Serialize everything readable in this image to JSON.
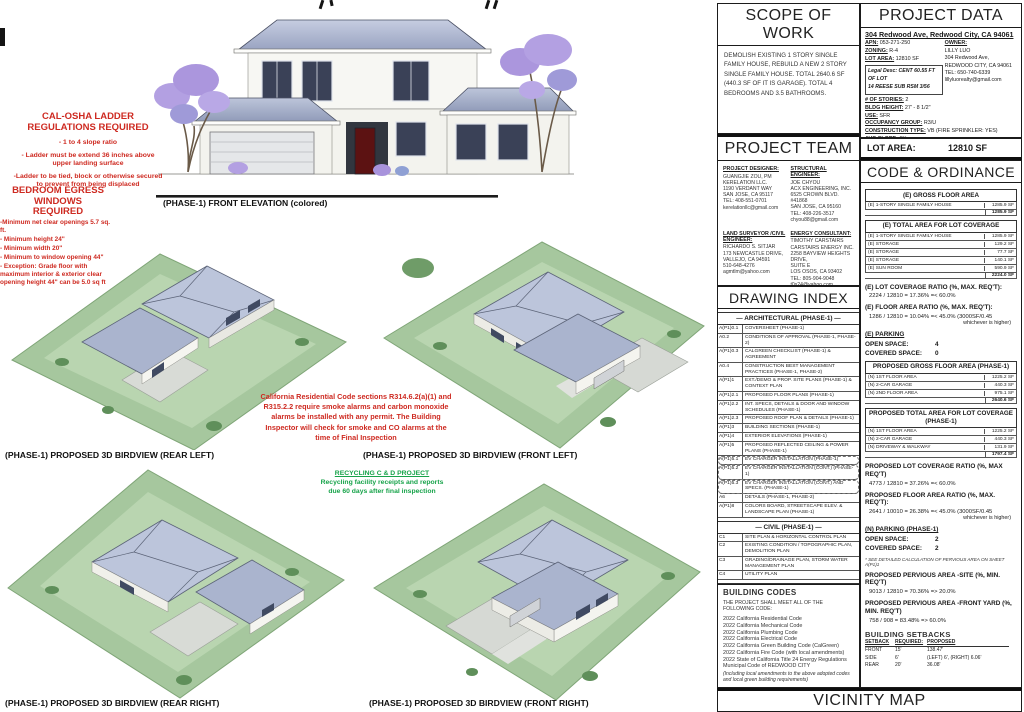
{
  "annotations": {
    "cal_osha": {
      "title_line1": "CAL-OSHA LADDER",
      "title_line2": "REGULATIONS REQUIRED",
      "items": [
        "- 1 to 4 slope ratio",
        "- Ladder must be extend 36 inches above upper landing surface",
        "-Ladder to be tied, block or otherwise secured to prevent from being displaced"
      ]
    },
    "egress": {
      "title_line1": "BEDROOM EGRESS",
      "title_line2": "WINDOWS",
      "title_line3": "REQUIRED",
      "items": [
        "-Minimum net clear openings 5.7 sq. ft.",
        "- Minimum height 24\"",
        "- Minimum width 20\"",
        "- Minimum to window opening 44\"",
        "- Exception: Grade floor with maximum interior & exterior clear opening height 44\" can be 5.0 sq ft"
      ]
    },
    "smoke_co": "California Residential Code sections R314.6.2(a)(1) and R315.2.2 require smoke alarms and carbon monoxide alarms be installed with any permit. The Building Inspector will check for smoke and CO alarms at the time of Final Inspection",
    "recycling": {
      "title": "RECYCLING C & D PROJECT",
      "body": "Recycling facility receipts and reports due 60 days after final inspection"
    }
  },
  "captions": {
    "front_elevation": "(PHASE-1) FRONT ELEVATION (colored)",
    "rear_left": "(PHASE-1) PROPOSED 3D BIRDVIEW (REAR LEFT)",
    "front_left": "(PHASE-1) PROPOSED 3D BIRDVIEW (FRONT LEFT)",
    "rear_right": "(PHASE-1) PROPOSED 3D BIRDVIEW (REAR RIGHT)",
    "front_right": "(PHASE-1) PROPOSED 3D BIRDVIEW (FRONT RIGHT)"
  },
  "scope_of_work": {
    "title": "SCOPE OF WORK",
    "body": "DEMOLISH EXISTING 1 STORY SINGLE FAMILY HOUSE, REBUILD A NEW 2 STORY SINGLE FAMILY HOUSE. TOTAL 2640.6 SF (440.3 SF OF IT IS GARAGE). TOTAL 4 BEDROOMS AND 3.5 BATHROOMS."
  },
  "project_data": {
    "title": "PROJECT DATA",
    "address": "304 Redwood Ave, Redwood City, CA 94061",
    "left_fields": [
      {
        "label": "APN:",
        "value": "053-271-250"
      },
      {
        "label": "ZONING:",
        "value": "R-4"
      },
      {
        "label": "LOT AREA:",
        "value": "12810 SF"
      }
    ],
    "legal_line1": "Legal Desc: CENT 60.55 FT OF LOT",
    "legal_line2": "14 REESE SUB RSM 3/56",
    "owner_heading": "OWNER:",
    "owner_lines": [
      "LILLY LUO",
      "304 Redwood Ave,",
      "REDWOOD CITY, CA 94061",
      "TEL:    650-740-6339",
      "lillyluorealty@gmail.com"
    ],
    "bottom_fields": [
      {
        "label": "# OF STORIES:",
        "value": "2"
      },
      {
        "label": "BLDG HEIGHT:",
        "value": "27' - 8 1/2\""
      },
      {
        "label": "USE:",
        "value": "SFR"
      },
      {
        "label": "OCCUPANCY GROUP:",
        "value": "R3/U"
      },
      {
        "label": "CONSTRUCTION TYPE:",
        "value": "VB (FIRE SPRINKLER: YES)"
      },
      {
        "label": "AVG SLOPE:",
        "value": "6%"
      }
    ],
    "lot_area_label": "LOT AREA:",
    "lot_area_value": "12810 SF"
  },
  "project_team": {
    "title": "PROJECT TEAM",
    "designer": {
      "heading": "PROJECT DESIGNER:",
      "lines": [
        "GUANGJIE ZOU, PM",
        "KERELATION LLC.",
        "1190 VERDANT WAY",
        "SAN JOSE, CA 95117",
        "TEL: 408-551-0701",
        "kerelationllc@gmail.com"
      ]
    },
    "structural": {
      "heading": "STRUCTURAL ENGINEER:",
      "lines": [
        "JOE CHYOU",
        "ACX ENGINEERING, INC.",
        "6525 CROWN BLVD. #41868",
        "SAN JOSE, CA 95160",
        "TEL: 408-226-3517",
        "chyou88@gmail.com"
      ]
    },
    "surveyor": {
      "heading": "LAND SURVEYOR /CIVIL ENGINEER:",
      "lines": [
        "RICHARDO S. SITJAR",
        "173 NEWCASTLE DRIVE,",
        "VALLEJO, CA 94591",
        "510-648-4276",
        "agmtlm@yahoo.com"
      ]
    },
    "energy": {
      "heading": "ENERGY CONSULTANT:",
      "lines": [
        "TIMOTHY CARSTAIRS",
        "CARSTAIRS ENERGY INC.",
        "2258 BAYVIEW HEIGHTS DRIVE,",
        "SUITE E",
        "LOS OSOS, CA 93402",
        "TEL: 805-904-9048",
        "t0s24@yahoo.com"
      ]
    }
  },
  "drawing_index": {
    "title": "DRAWING INDEX",
    "arch_heading": "— ARCHITECTURAL (PHASE-1) —",
    "arch_rows": [
      {
        "code": "A(P1)0.1",
        "title": "COVERSHEET (PHASE-1)"
      },
      {
        "code": "A0.2",
        "title": "CONDITIONS OF APPROVAL (PHASE-1, PHASE-2)"
      },
      {
        "code": "A(P1)0.3",
        "title": "CALGREEN CHECKLIST (PHASE-1) & AGREEMENT"
      },
      {
        "code": "A0.4",
        "title": "CONSTRUCTION BEST MANAGEMENT PRACTICES (PHASE-1, PHASE-2)"
      },
      {
        "code": "A(P1)1",
        "title": "EXT./DEMO & PROP. SITE PLANS (PHASE-1) & CONTEXT PLAN"
      },
      {
        "code": "A(P1)2.1",
        "title": "PROPOSED FLOOR PLANS (PHASE-1)"
      },
      {
        "code": "A(P1)2.2",
        "title": "INT. SPECS, DETAILS & DOOR AND WINDOW SCHEDULES (PHASE-1)"
      },
      {
        "code": "A(P1)2.3",
        "title": "PROPOSED ROOF PLAN & DETAILS (PHASE-1)"
      },
      {
        "code": "A(P1)3",
        "title": "BUILDING SECTIONS (PHASE-1)"
      },
      {
        "code": "A(P1)4",
        "title": "EXTERIOR ELEVATIONS (PHASE-1)"
      },
      {
        "code": "A(P1)5",
        "title": "PROPOSED REFLECTED CEILING & POWER PLANS (PHASE-1)"
      },
      {
        "code": "A(P1)5.1",
        "title": "EV CHARGER INSTALLATION (PHASE-1)"
      },
      {
        "code": "A(P1)5.2",
        "title": "EV CHARGER INSTALLATION (CONT.) (PHASE-1)"
      },
      {
        "code": "A(P1)5.3",
        "title": "EV CHARGER INSTALLATION (CONT.) AND SPECS. (PHASE-1)"
      },
      {
        "code": "A6",
        "title": "DETAILS (PHASE-1, PHASE-2)"
      },
      {
        "code": "A(P1)8",
        "title": "COLORS BOARD, STREETSCAPE ELEV. & LANDSCAPE PLAN (PHASE-1)"
      }
    ],
    "civil_heading": "— CIVIL (PHASE-1) —",
    "civil_rows": [
      {
        "code": "C1",
        "title": "SITE PLAN & HORIZONTAL CONTROL PLAN"
      },
      {
        "code": "C2",
        "title": "EXISTING CONDITION / TOPOGRAPHIC PLAN, DEMOLITION PLAN"
      },
      {
        "code": "C3",
        "title": "GRADING/DRAINAGE PLAN, STORM WATER MANAGEMENT PLAN"
      },
      {
        "code": "C4",
        "title": "UTILITY PLAN"
      }
    ],
    "energy_heading": "— ENERGY REPORT —",
    "energy_rows": [
      {
        "code": "T24.1",
        "title": "ENERGY REPORT - CF1R-PRF-01"
      },
      {
        "code": "T24.2",
        "title": "ENERGY REPORT - CF1R-PRF-01 & RMS"
      }
    ],
    "structural_heading": "— STRUCTURAL —",
    "structural_rows": [
      {
        "code": "S-1",
        "title": "STRUCTURE NOTES"
      },
      {
        "code": "S-2",
        "title": "STRUCTURAL DETAILS"
      },
      {
        "code": "S-3",
        "title": "STRUCTURAL DETAILS"
      },
      {
        "code": "S-4",
        "title": "FOUNDATION PLAN"
      },
      {
        "code": "S-5",
        "title": "2ND FLOOR FRAMING & FOUNDATION PLANS"
      },
      {
        "code": "S-6",
        "title": "UPPER ROOF AND LOW ROOF FRAMING PLANS"
      }
    ]
  },
  "building_codes": {
    "title": "BUILDING CODES",
    "intro": "THE PROJECT SHALL MEET ALL OF THE FOLLOWING CODE:",
    "items": [
      "2022   California Residential Code",
      "2022   California Mechanical Code",
      "2022   California Plumbing Code",
      "2022   California Electrical Code",
      "2022   California Green Building Code (CalGreen)",
      "2022   California Fire Code (with local amendments)",
      "2022   State of California Title 24 Energy Regulations",
      "Municipal Code of REDWOOD CITY"
    ],
    "note": "(Including local amendments to the above adopted codes and local green building requirements)"
  },
  "code_ordinance": {
    "title": "CODE & ORDINANCE",
    "e_gross_heading": "(E) GROSS FLOOR AREA",
    "e_gross_rows": [
      {
        "label": "(E) 1-STORY SINGLE FAMILY HOUSE",
        "value": "1285.9 SF"
      }
    ],
    "e_gross_total": "1285.9 SF",
    "e_cov_heading": "(E) TOTAL AREA FOR LOT COVERAGE",
    "e_cov_rows": [
      {
        "label": "(E) 1-STORY SINGLE FAMILY HOUSE",
        "value": "1285.9 SF"
      },
      {
        "label": "(E) STORAGE",
        "value": "129.2 SF"
      },
      {
        "label": "(E) STORAGE",
        "value": "77.7 SF"
      },
      {
        "label": "(E) STORAGE",
        "value": "140.1 SF"
      },
      {
        "label": "(E) SUN ROOM",
        "value": "590.9 SF"
      }
    ],
    "e_cov_total": "2224.0 SF",
    "e_lot_ratio_title": "(E) LOT COVERAGE RATIO (%, MAX. REQ'T):",
    "e_lot_ratio_calc": "2224 / 12810     =  17.36%  =< 60.0%",
    "e_far_title": "(E) FLOOR AREA RATIO (%, MAX. REQ'T):",
    "e_far_calc": "1286 / 12810     =  10.04%  =< 45.0%   (3000SF/0.45",
    "e_far_note": "whichever is higher)",
    "e_parking_title": "(E) PARKING",
    "open_space_label": "OPEN SPACE:",
    "covered_space_label": "COVERED SPACE:",
    "e_open": "4",
    "e_covered": "0",
    "p_gross_heading": "PROPOSED GROSS FLOOR AREA (PHASE-1)",
    "p_gross_rows": [
      {
        "label": "(N) 1ST FLOOR AREA",
        "value": "1225.2 SF"
      },
      {
        "label": "(N) 2-CAR GARAGE",
        "value": "440.3 SF"
      },
      {
        "label": "(N) 2ND FLOOR AREA",
        "value": "975.1 SF"
      }
    ],
    "p_gross_total": "2640.6 SF",
    "p_cov_heading": "PROPOSED TOTAL AREA FOR LOT COVERAGE (PHASE-1)",
    "p_cov_rows": [
      {
        "label": "(N) 1ST FLOOR AREA",
        "value": "1225.2 SF"
      },
      {
        "label": "(N) 2-CAR GARAGE",
        "value": "440.3 SF"
      },
      {
        "label": "(N) DRIVEWAY & WALKWAY",
        "value": "131.9 SF"
      }
    ],
    "p_cov_total": "1797.4 SF",
    "p_lot_ratio_title": "PROPOSED LOT COVERAGE RATIO (%, MAX REQ'T)",
    "p_lot_ratio_calc": "4773 / 12810     =  37.26%  =< 60.0%",
    "p_far_title": "PROPOSED FLOOR AREA RATIO (%, MAX. REQ'T):",
    "p_far_calc": "2641 / 10010     =  26.38%  =< 45.0%   (3000SF/0.45",
    "p_far_note": "whichever is higher)",
    "n_parking_title": "(N) PARKING (PHASE-1)",
    "n_open": "2",
    "n_covered": "2",
    "pervious_note": "* SEE DETAILED CALCULATION OF PERVIOUS AREA ON SHEET A(P1)1",
    "pervious_site_title": "PROPOSED PERVIOUS AREA -SITE (%, MIN. REQ'T)",
    "pervious_site_calc": "9013 / 12810     =  70.36%  => 20.0%",
    "pervious_front_title": "PROPOSED PERVIOUS AREA -FRONT YARD (%, MIN. REQ'T)",
    "pervious_front_calc": "758 / 908     =  83.48%  => 60.0%",
    "setbacks_title": "BUILDING SETBACKS",
    "setbacks_header": {
      "a": "SETBACK",
      "b": "REQUIRED:",
      "c": "PROPOSED"
    },
    "setbacks_rows": [
      {
        "a": "FRONT",
        "b": "15'",
        "c": "138.47'"
      },
      {
        "a": "SIDE",
        "b": "6'",
        "c": "(LEFT) 6', (RIGHT) 6.06'"
      },
      {
        "a": "REAR",
        "b": "20'",
        "c": "36.08'"
      }
    ]
  },
  "vicinity": {
    "title": "VICINITY MAP"
  }
}
